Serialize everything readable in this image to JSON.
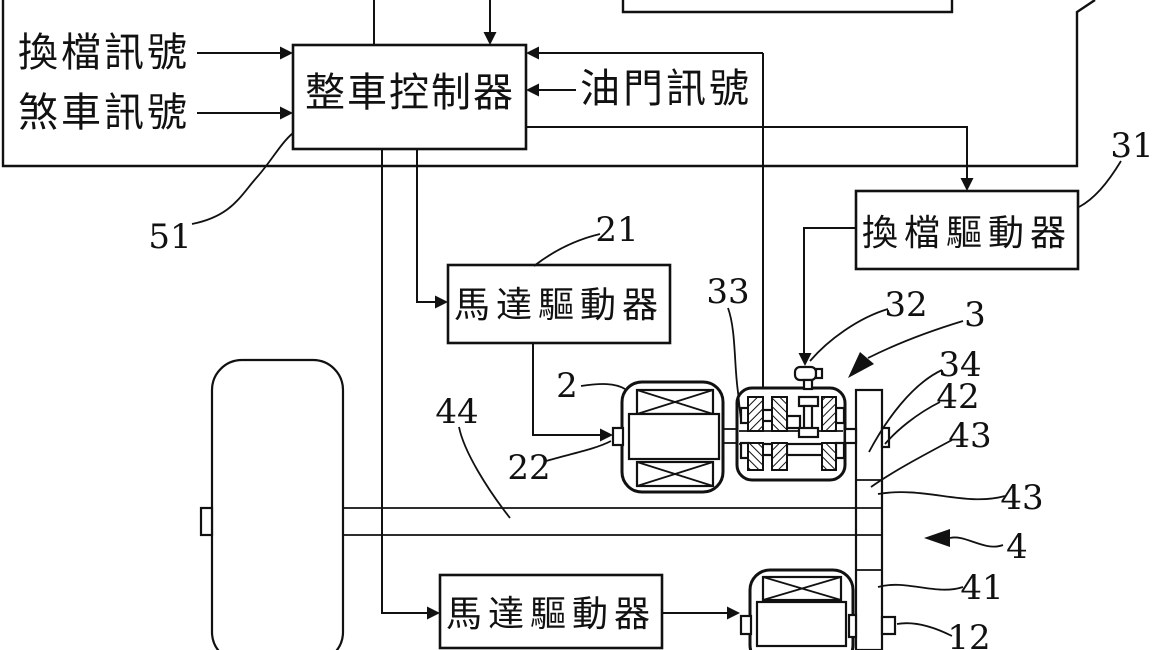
{
  "figure": {
    "type": "patent block-and-mechanism diagram (electric vehicle powertrain control)",
    "colors": {
      "ink": "#111111",
      "background": "#ffffff"
    },
    "blocks": {
      "controller": {
        "label": "整車控制器"
      },
      "shift_driver": {
        "label": "換檔驅動器"
      },
      "motor_driver_upper": {
        "label": "馬達驅動器"
      },
      "motor_driver_lower": {
        "label": "馬達驅動器"
      }
    },
    "signals": {
      "shift_signal": "換檔訊號",
      "brake_signal": "煞車訊號",
      "throttle_signal": "油門訊號"
    },
    "reference_numerals": {
      "n51": "51",
      "n21": "21",
      "n2": "2",
      "n22": "22",
      "n44": "44",
      "n33": "33",
      "n32": "32",
      "n3": "3",
      "n34": "34",
      "n42": "42",
      "n43a": "43",
      "n43b": "43",
      "n4": "4",
      "n41": "41",
      "n12": "12",
      "n31": "31"
    }
  }
}
